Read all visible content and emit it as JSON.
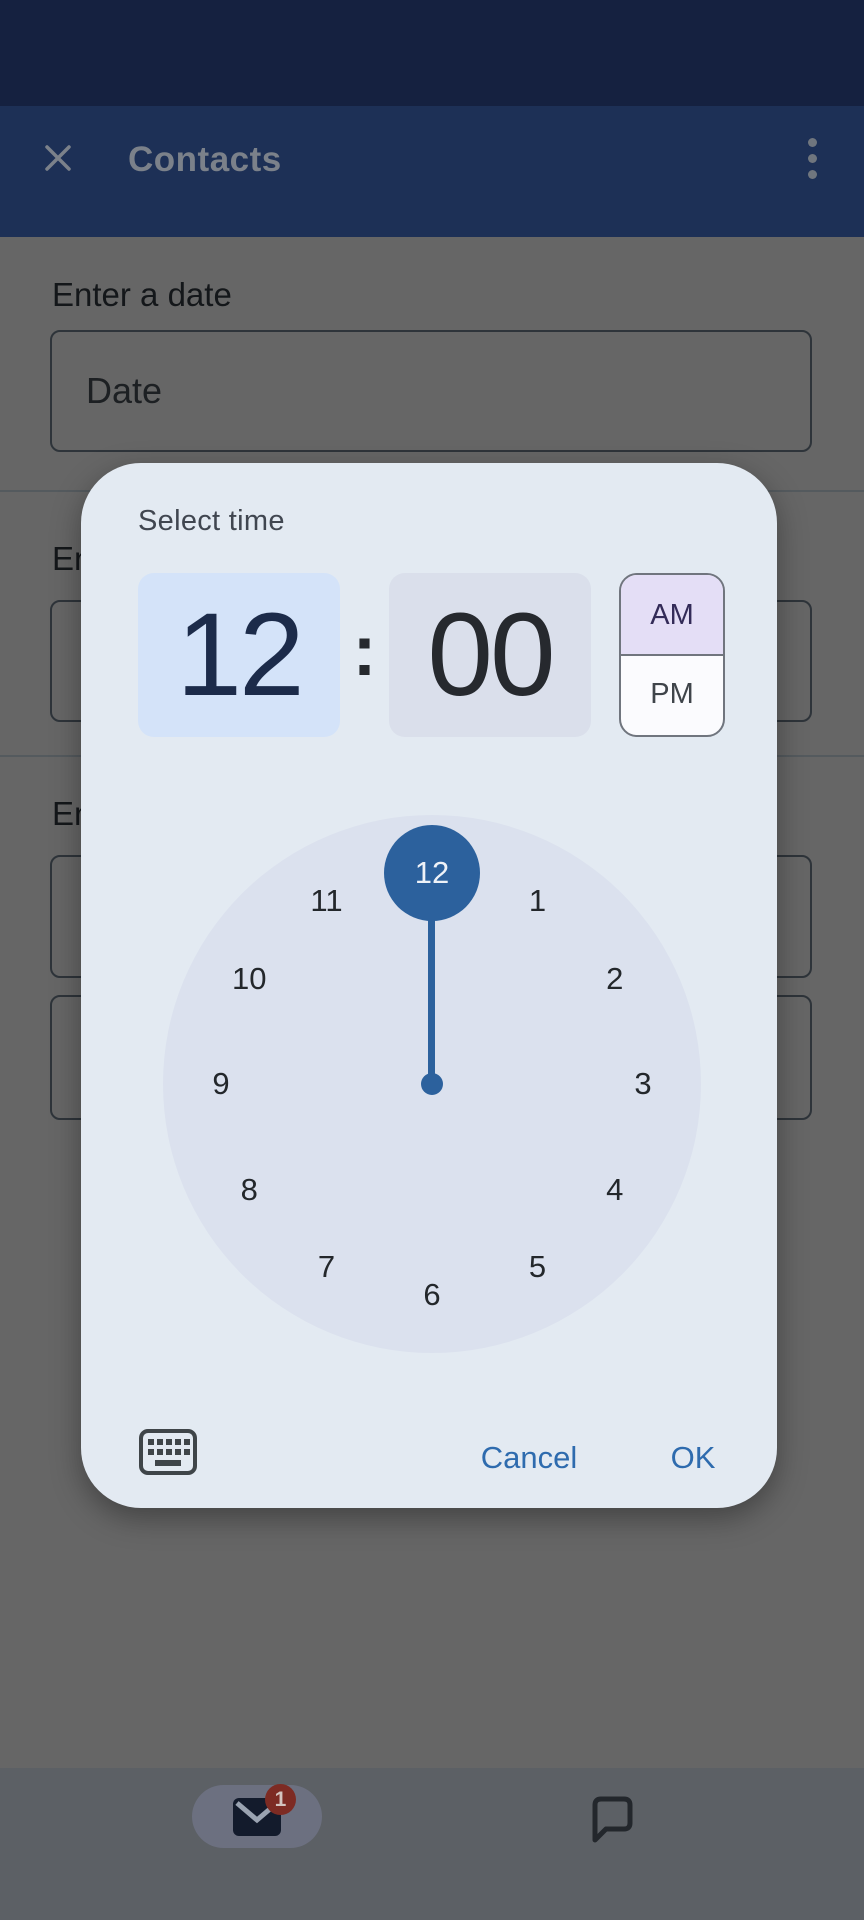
{
  "app_bar": {
    "title": "Contacts"
  },
  "form": {
    "sections": [
      {
        "label": "Enter a date",
        "inputs": [
          {
            "placeholder": "Date"
          }
        ]
      },
      {
        "label": "En",
        "inputs": [
          {
            "placeholder": ""
          }
        ]
      },
      {
        "label": "En",
        "inputs": [
          {
            "placeholder": ""
          },
          {
            "placeholder": ""
          }
        ]
      }
    ]
  },
  "dialog": {
    "title": "Select time",
    "hour": "12",
    "colon": ":",
    "minute": "00",
    "ampm": {
      "am": "AM",
      "pm": "PM",
      "selected": "AM"
    },
    "clock": {
      "numbers": [
        "12",
        "1",
        "2",
        "3",
        "4",
        "5",
        "6",
        "7",
        "8",
        "9",
        "10",
        "11"
      ],
      "selected": "12"
    },
    "actions": {
      "cancel": "Cancel",
      "ok": "OK"
    }
  },
  "bottom_nav": {
    "tabs": [
      {
        "icon": "mail",
        "badge": "1",
        "active": true
      },
      {
        "icon": "chat",
        "active": false
      }
    ]
  },
  "colors": {
    "status_bar": "#152140",
    "app_bar": "#1d3056",
    "scrimmed_background": "#666666",
    "dialog_background": "#e3eaf2",
    "hour_cell_background": "#d4e3f9",
    "minute_cell_background": "#dadfeb",
    "am_selected_background": "#e4def6",
    "clock_face": "#dbe1ee",
    "selection_blue": "#2c619d",
    "action_blue": "#2e6bae",
    "badge_red": "#7d2b23"
  }
}
